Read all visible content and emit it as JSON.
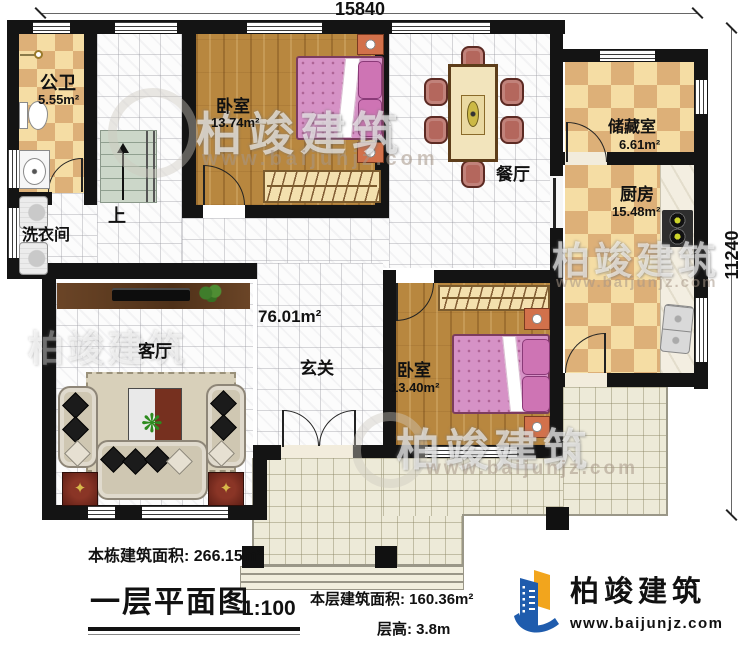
{
  "dimensions": {
    "width_mm": "15840",
    "height_mm": "11240"
  },
  "rooms": {
    "bathroom": {
      "name": "公卫",
      "area": "5.55m²"
    },
    "bedroom1": {
      "name": "卧室",
      "area": "13.74m²"
    },
    "bedroom2": {
      "name": "卧室",
      "area": "13.40m²"
    },
    "dining": {
      "name": "餐厅"
    },
    "storage": {
      "name": "储藏室",
      "area": "6.61m²"
    },
    "kitchen": {
      "name": "厨房",
      "area": "15.48m²"
    },
    "laundry": {
      "name": "洗衣间"
    },
    "living": {
      "name": "客厅"
    },
    "foyer": {
      "name": "玄关"
    },
    "hall": {
      "area": "76.01m²"
    },
    "stairs": {
      "label": "上"
    }
  },
  "annotations": {
    "total_area": "本栋建筑面积: 266.15m²",
    "floor_plan_title": "一层平面图",
    "scale": "1:100",
    "floor_area": "本层建筑面积: 160.36m²",
    "floor_height": "层高: 3.8m"
  },
  "branding": {
    "company": "柏竣建筑",
    "website": "www.baijunjz.com"
  },
  "watermark": {
    "company": "柏竣建筑",
    "website": "www.baijunjz.com"
  },
  "colors": {
    "wall": "#141414",
    "checker_light": "#f5dda4",
    "checker_dark": "#ddb078",
    "wood": "#b8873f",
    "terrace": "#edead8",
    "tile": "#fcfcfc",
    "logo_blue": "#1f5cad",
    "logo_orange": "#f2a51d",
    "bed_pink": "#d692c6"
  }
}
